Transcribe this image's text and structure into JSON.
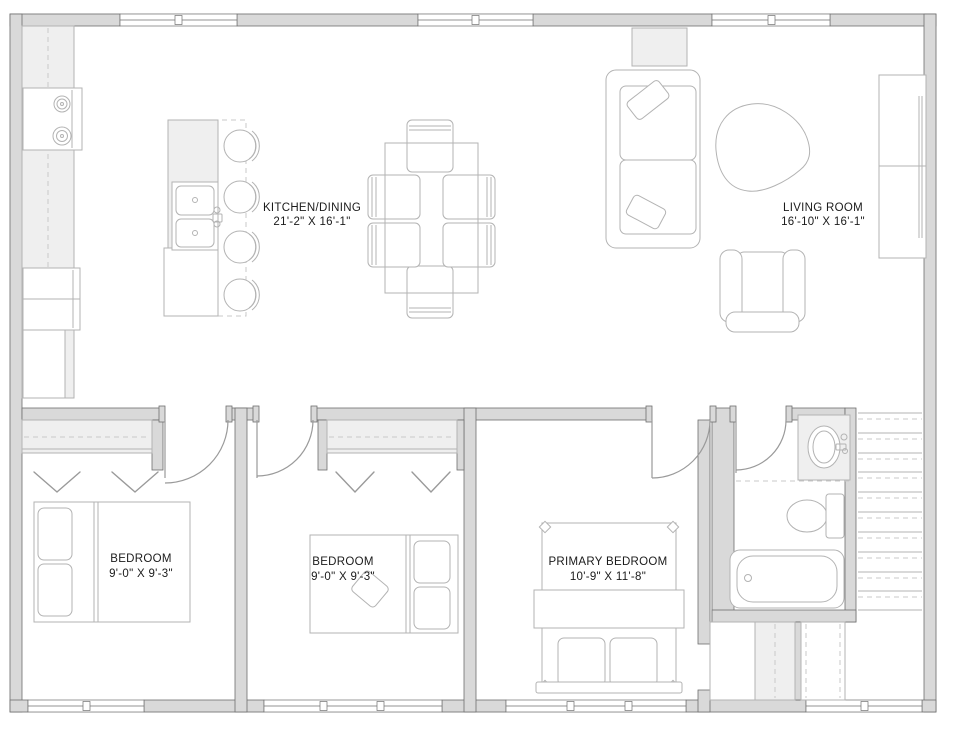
{
  "rooms": {
    "kitchen_dining": {
      "name": "KITCHEN/DINING",
      "dims": "21'-2\" X 16'-1\""
    },
    "living_room": {
      "name": "LIVING ROOM",
      "dims": "16'-10\" X 16'-1\""
    },
    "bedroom_left": {
      "name": "BEDROOM",
      "dims": "9'-0\" X 9'-3\""
    },
    "bedroom_middle": {
      "name": "BEDROOM",
      "dims": "9'-0\" X 9'-3\""
    },
    "primary_bedroom": {
      "name": "PRIMARY BEDROOM",
      "dims": "10'-9\" X 11'-8\""
    }
  },
  "colors": {
    "wall": "#d9d9d9",
    "wallEdge": "#6f6f6f",
    "outline": "#3a3a3a",
    "furniture": "#b3b3b3",
    "dashline": "#c9c9c9",
    "door": "#9a9a9a",
    "softFill": "#efefef",
    "text": "#1b1b1b"
  }
}
